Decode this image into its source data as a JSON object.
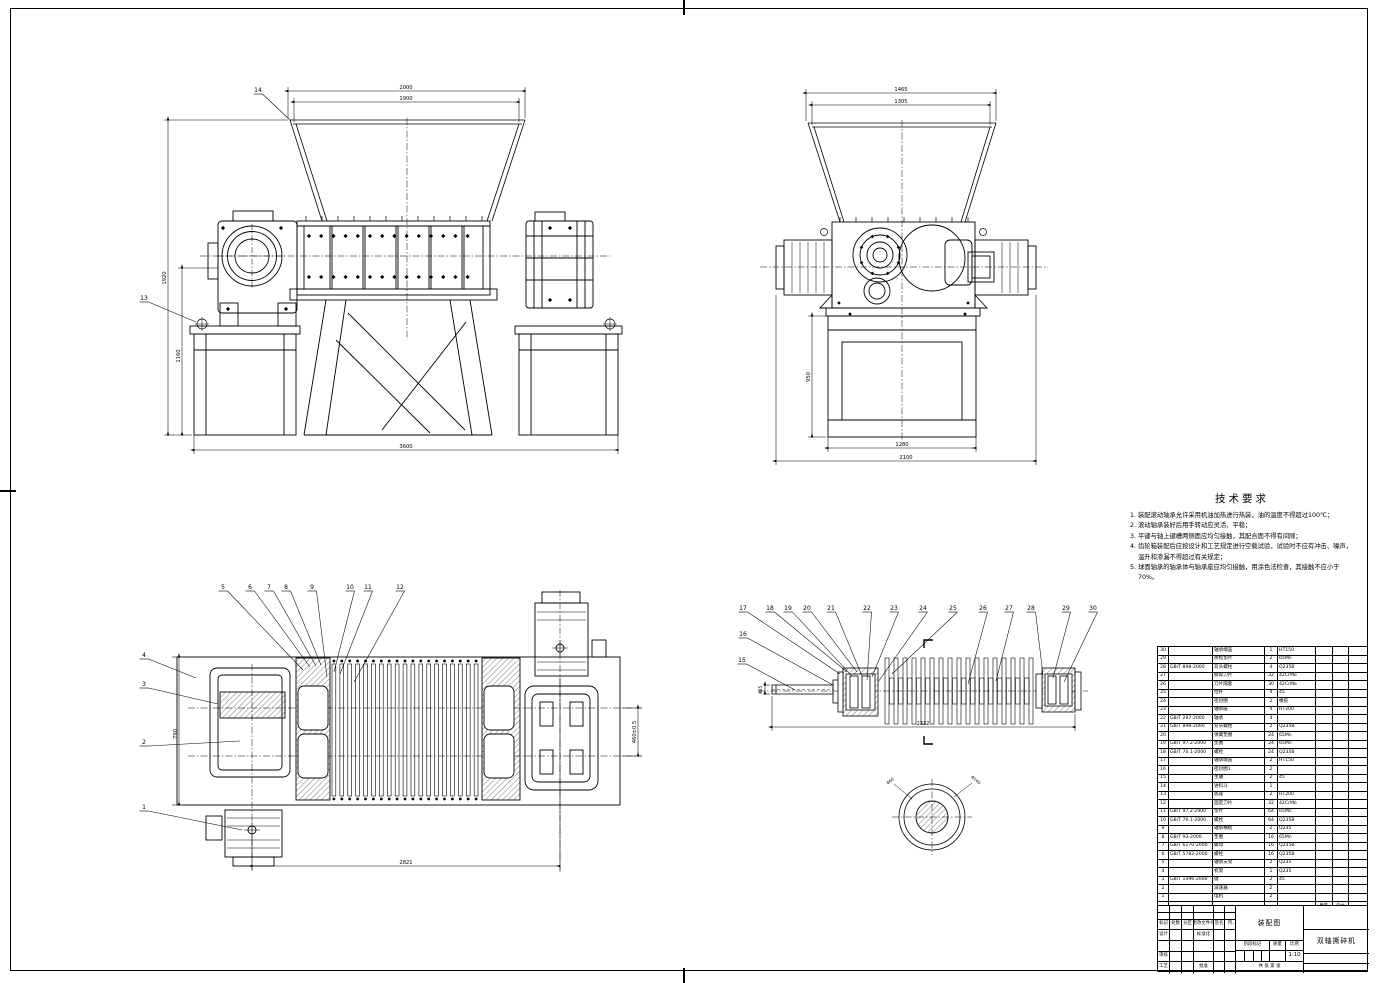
{
  "tech_requirements": {
    "title": "技术要求",
    "items": [
      "1. 装配滚动轴承允许采用机油加热进行热装，油的温度不得超过100℃；",
      "2. 滚动轴承装好后用手转动应灵活、平稳；",
      "3. 平键与轴上键槽两侧面应均匀接触，其配合面不得有间隙；",
      "4. 齿轮箱装配后应按设计和工艺规定进行空载试验，试验时不应有冲击、噪声，温升和渗漏不得超过有关规定；",
      "5. 球面轴承的轴承体与轴承座应均匀接触，用涂色法检查，其接触不应小于70%。"
    ]
  },
  "views": {
    "front": {
      "callouts": [
        "14",
        "13"
      ],
      "dims": {
        "top_outer": "2000",
        "top_inner": "1900",
        "height": "1920",
        "stand_height": "1160",
        "bottom": "3600"
      }
    },
    "side": {
      "dims": {
        "top_outer": "1465",
        "top_inner": "1305",
        "leg_height": "950",
        "base_width": "1280",
        "bottom": "2100"
      }
    },
    "plan": {
      "callouts": [
        "1",
        "2",
        "3",
        "4",
        "5",
        "6",
        "7",
        "8",
        "9",
        "10",
        "11",
        "12"
      ],
      "dims": {
        "height": "790",
        "bottom": "2821",
        "center_distance": "460±0.5"
      }
    },
    "shaft": {
      "callouts": [
        "15",
        "16",
        "17",
        "18",
        "19",
        "20",
        "21",
        "22",
        "23",
        "24",
        "25",
        "26",
        "27",
        "28",
        "29",
        "30"
      ],
      "dims": {
        "length": "2332",
        "shaft_end": "Φ85"
      },
      "section_labels": [
        "Φ60",
        "Φ160"
      ]
    }
  },
  "parts_list": {
    "headers": {
      "no": "序号",
      "code": "代号",
      "name": "名称",
      "qty": "数量",
      "material": "材料",
      "weight_unit": "单件",
      "weight_total": "总计",
      "weight": "重量",
      "remark": "备注"
    },
    "rows": [
      {
        "no": "30",
        "code": "",
        "name": "轴承端盖",
        "qty": "1",
        "material": "HT150"
      },
      {
        "no": "29",
        "code": "",
        "name": "防松垫片",
        "qty": "2",
        "material": "65Mn"
      },
      {
        "no": "28",
        "code": "GB/T 898-2000",
        "name": "双头螺柱",
        "qty": "4",
        "material": "Q235B"
      },
      {
        "no": "27",
        "code": "",
        "name": "撕碎刀片",
        "qty": "32",
        "material": "42CrMo"
      },
      {
        "no": "26",
        "code": "",
        "name": "刀片隔套",
        "qty": "30",
        "material": "42CrMo"
      },
      {
        "no": "25",
        "code": "",
        "name": "拉杆",
        "qty": "4",
        "material": "45"
      },
      {
        "no": "24",
        "code": "",
        "name": "密封圈",
        "qty": "2",
        "material": "橡胶"
      },
      {
        "no": "23",
        "code": "",
        "name": "轴承座",
        "qty": "4",
        "material": "HT200"
      },
      {
        "no": "22",
        "code": "GB/T 297-2000",
        "name": "轴承",
        "qty": "4",
        "material": ""
      },
      {
        "no": "21",
        "code": "GB/T 898-2000",
        "name": "双头螺柱",
        "qty": "2",
        "material": "Q235B"
      },
      {
        "no": "20",
        "code": "",
        "name": "弹簧垫圈",
        "qty": "24",
        "material": "65Mn"
      },
      {
        "no": "19",
        "code": "GB/T 97.2-2000",
        "name": "垫圈",
        "qty": "24",
        "material": "65Mn"
      },
      {
        "no": "18",
        "code": "GB/T 70.1-2000",
        "name": "螺栓",
        "qty": "24",
        "material": "Q235B"
      },
      {
        "no": "17",
        "code": "",
        "name": "轴承端盖",
        "qty": "2",
        "material": "HT150"
      },
      {
        "no": "16",
        "code": "",
        "name": "密封圈1",
        "qty": "2",
        "material": ""
      },
      {
        "no": "15",
        "code": "",
        "name": "主轴",
        "qty": "2",
        "material": "45"
      },
      {
        "no": "14",
        "code": "",
        "name": "进料斗",
        "qty": "1",
        "material": ""
      },
      {
        "no": "13",
        "code": "",
        "name": "底座",
        "qty": "2",
        "material": "HT200"
      },
      {
        "no": "12",
        "code": "",
        "name": "固定刀片",
        "qty": "32",
        "material": "42CrMo"
      },
      {
        "no": "11",
        "code": "GB/T 97.2-2000",
        "name": "垫片",
        "qty": "64",
        "material": "65Mn"
      },
      {
        "no": "10",
        "code": "GB/T 70.1-2000",
        "name": "螺栓",
        "qty": "64",
        "material": "Q235B"
      },
      {
        "no": "9",
        "code": "",
        "name": "轴承横板",
        "qty": "2",
        "material": "Q235"
      },
      {
        "no": "8",
        "code": "GB/T 93-2000",
        "name": "垫圈",
        "qty": "16",
        "material": "65Mn"
      },
      {
        "no": "7",
        "code": "GB/T 6170-2000",
        "name": "螺母",
        "qty": "16",
        "material": "Q235B"
      },
      {
        "no": "6",
        "code": "GB/T 5782-2000",
        "name": "螺栓",
        "qty": "16",
        "material": "Q235B"
      },
      {
        "no": "5",
        "code": "",
        "name": "轴承支架",
        "qty": "2",
        "material": "Q235"
      },
      {
        "no": "4",
        "code": "",
        "name": "机架",
        "qty": "1",
        "material": "Q235"
      },
      {
        "no": "3",
        "code": "GB/T 1096-2000",
        "name": "键",
        "qty": "2",
        "material": "45"
      },
      {
        "no": "2",
        "code": "",
        "name": "减速器",
        "qty": "2",
        "material": ""
      },
      {
        "no": "1",
        "code": "",
        "name": "电机",
        "qty": "2",
        "material": ""
      }
    ]
  },
  "title_block": {
    "drawing_type": "装配图",
    "product_name": "双轴撕碎机",
    "scale": "1:10",
    "labels": {
      "mark": "标记",
      "count": "处数",
      "zone": "分区",
      "change_file": "更改文件号",
      "sign": "签名",
      "date": "年、月、日",
      "design": "设计",
      "standardize": "标准化",
      "check": "审核",
      "process": "工艺",
      "approve": "批准",
      "stage_mark": "阶段标记",
      "weight": "质量",
      "scale": "比例",
      "sheet_note": "共  张  第  张"
    }
  }
}
